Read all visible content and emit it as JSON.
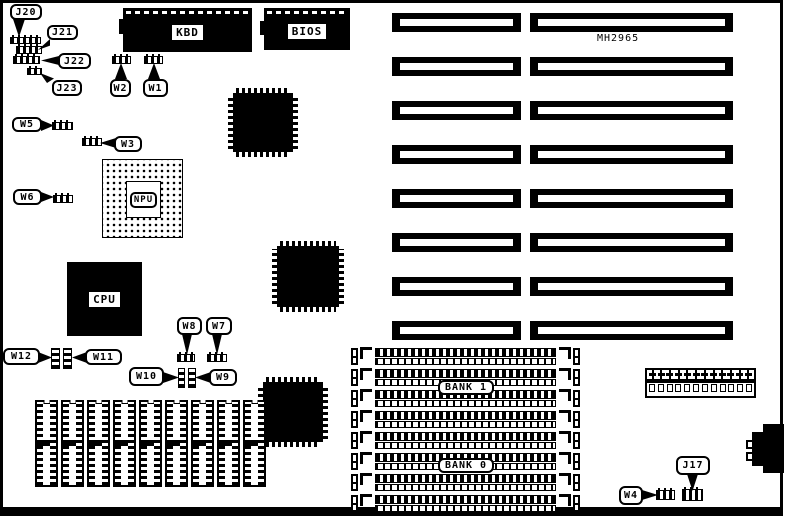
{
  "colors": {
    "ink": "#000000",
    "paper": "#ffffff"
  },
  "board": {
    "part_number": "MH2965"
  },
  "chips": {
    "kbd": "KBD",
    "bios": "BIOS",
    "npu": "NPU",
    "cpu": "CPU"
  },
  "memory": {
    "bank1": "BANK 1",
    "bank0": "BANK 0"
  },
  "jumper_labels": {
    "j20": "J20",
    "j21": "J21",
    "j22": "J22",
    "j23": "J23",
    "j17": "J17",
    "w1": "W1",
    "w2": "W2",
    "w3": "W3",
    "w4": "W4",
    "w5": "W5",
    "w6": "W6",
    "w7": "W7",
    "w8": "W8",
    "w9": "W9",
    "w10": "W10",
    "w11": "W11",
    "w12": "W12"
  },
  "counts": {
    "isa_slot_rows": 8,
    "simm_sockets": 8,
    "dip_sockets": 9,
    "power_connector_pins": 12
  }
}
